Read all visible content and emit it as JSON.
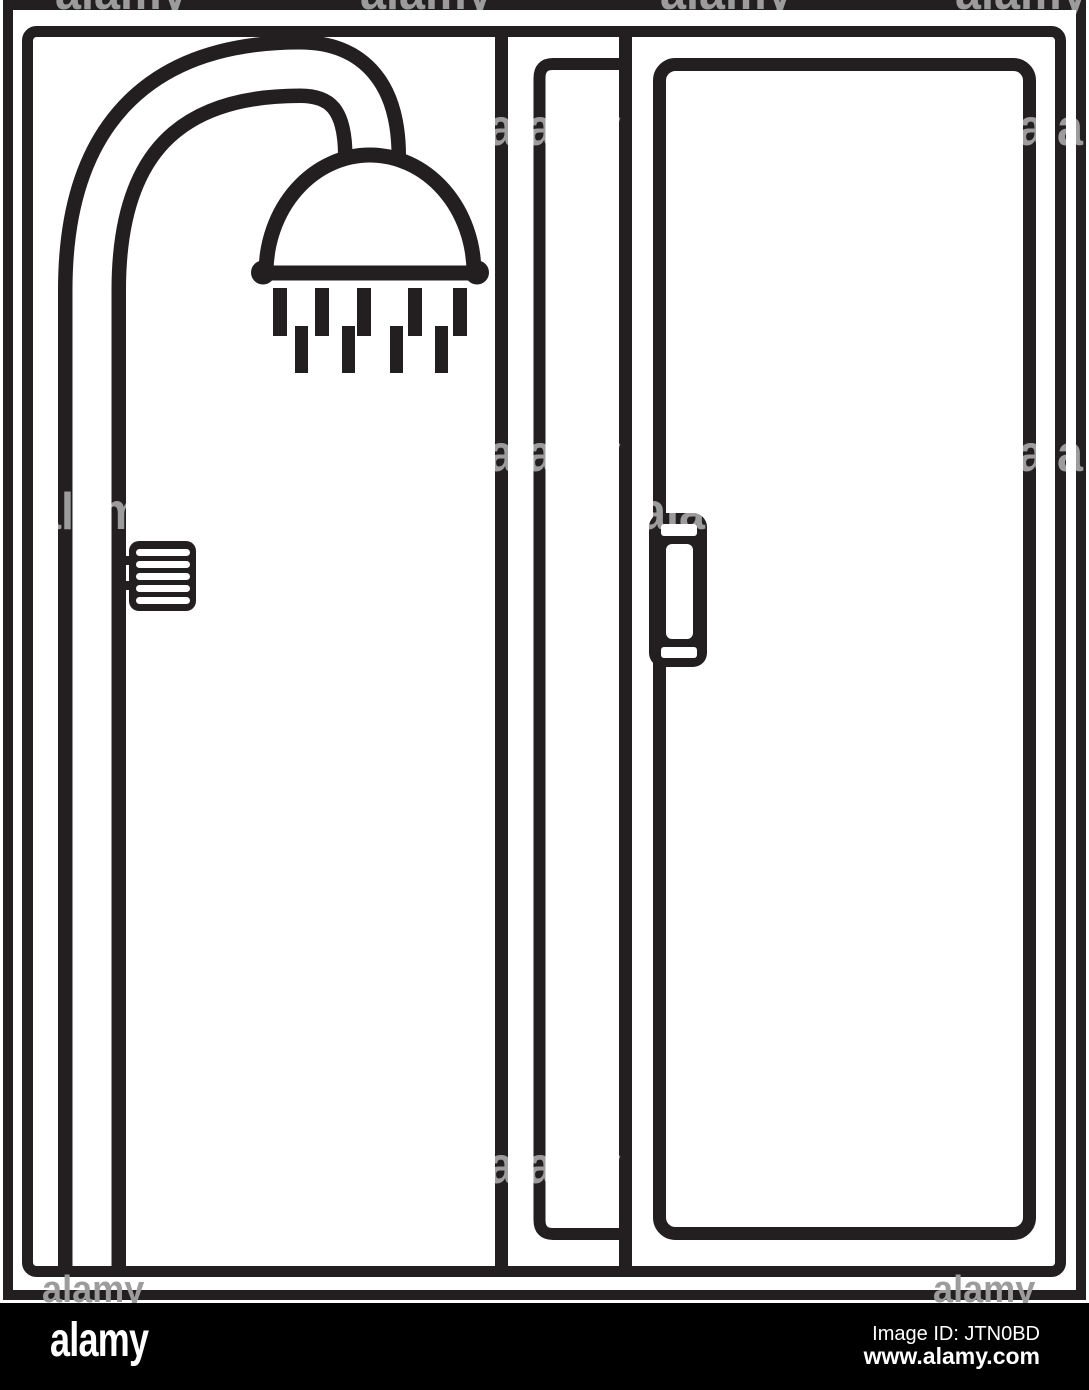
{
  "colors": {
    "ink": "#231f20",
    "background": "#ffffff",
    "footer_bg": "#000000",
    "watermark_gray": "#9c9c9c",
    "text_white": "#ffffff"
  },
  "illustration": {
    "subject": "shower cabin line icon",
    "icons": [
      "shower-pipe-icon",
      "shower-head-icon",
      "water-drops-icon",
      "temperature-knob-icon",
      "glass-panel-icon",
      "door-handle-icon"
    ]
  },
  "watermark": {
    "word": "alamy",
    "letter": "a",
    "fragments": [
      {
        "text": "alamy",
        "x": 55,
        "y": -34
      },
      {
        "text": "alamy",
        "x": 360,
        "y": -34
      },
      {
        "text": "alamy",
        "x": 660,
        "y": -34
      },
      {
        "text": "alamy",
        "x": 955,
        "y": -34
      },
      {
        "text": "alamy",
        "x": 488,
        "y": 102
      },
      {
        "text": "alamy",
        "x": 1018,
        "y": 102
      },
      {
        "text": "alamy",
        "x": 488,
        "y": 428
      },
      {
        "text": "alamy",
        "x": 1018,
        "y": 428
      },
      {
        "text": "alamy",
        "x": 35,
        "y": 486
      },
      {
        "text": "alamy",
        "x": 640,
        "y": 486
      },
      {
        "text": "alamy",
        "x": 488,
        "y": 1140
      }
    ],
    "bottom_words": [
      {
        "text": "alamy",
        "x": 42,
        "y": 1271
      },
      {
        "text": "alamy",
        "x": 933,
        "y": 1271
      }
    ]
  },
  "footer": {
    "logo": "alamy",
    "image_id": "Image ID: JTN0BD",
    "website": "www.alamy.com"
  }
}
